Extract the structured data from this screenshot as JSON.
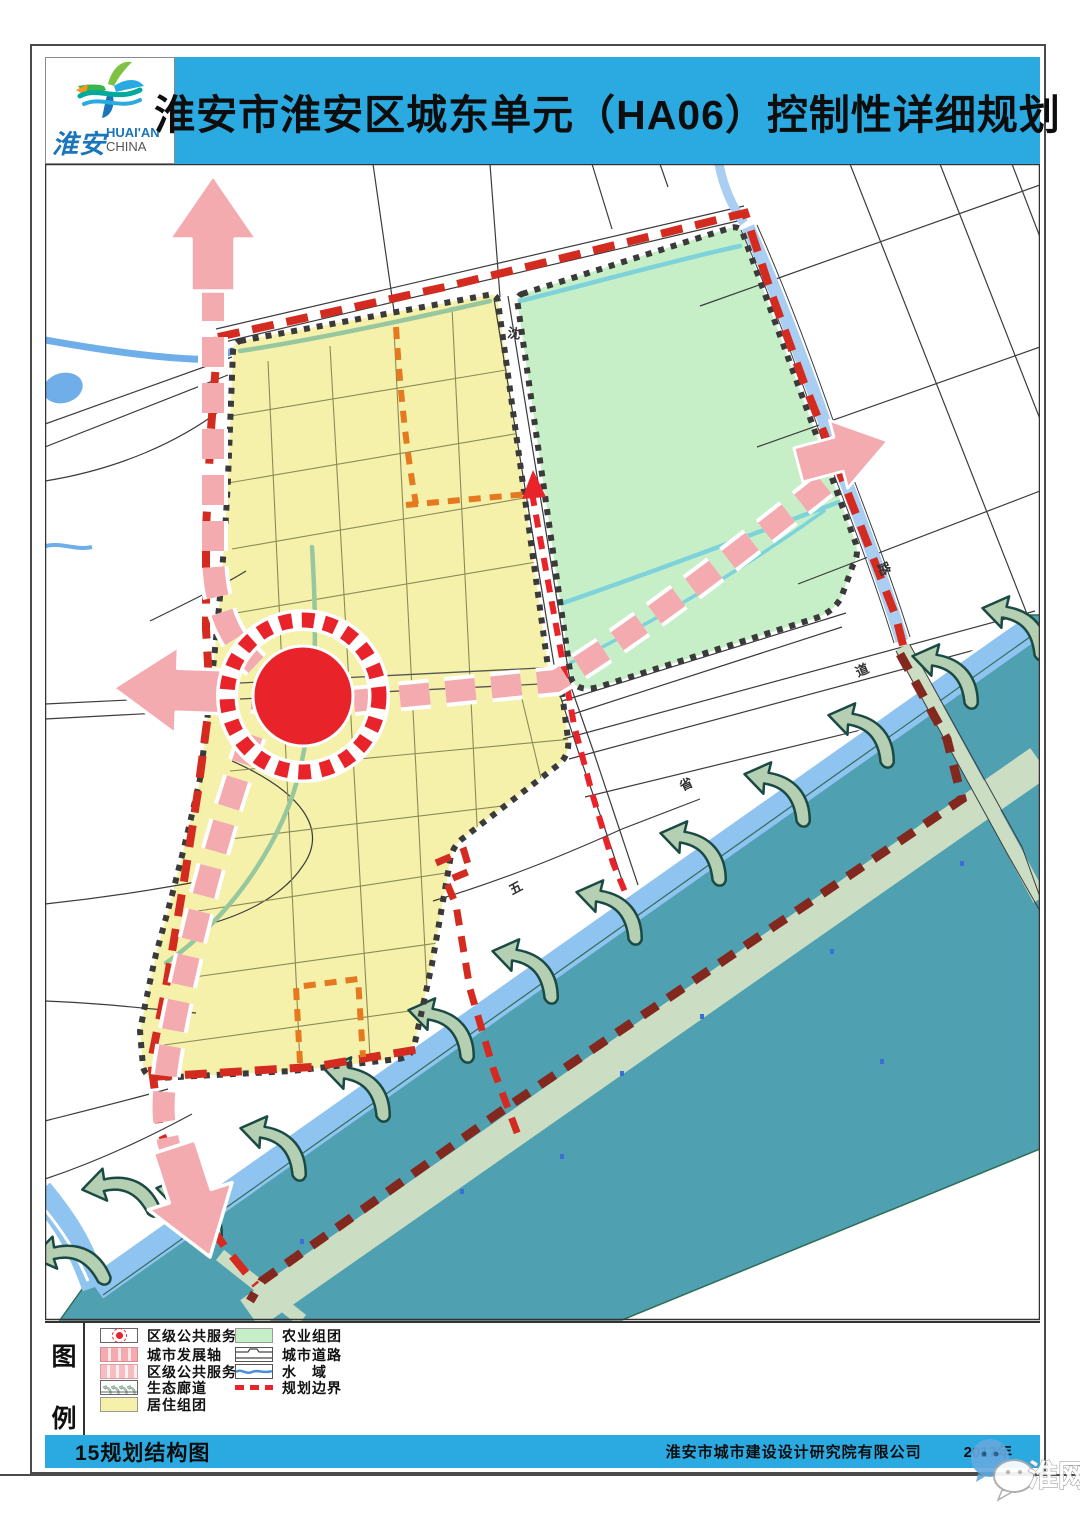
{
  "header": {
    "title": "淮安市淮安区城东单元（HA06）控制性详细规划",
    "logo": {
      "cn": "淮安",
      "en_line1": "HUAI'AN",
      "en_line2": "CHINA"
    }
  },
  "legend": {
    "panel_title_char1": "图",
    "panel_title_char2": "例",
    "col1": [
      {
        "label": "区级公共服务中心",
        "icon": "service-center-symbol"
      },
      {
        "label": "城市发展轴",
        "icon": "city-development-axis-swatch"
      },
      {
        "label": "区级公共服务轴",
        "icon": "district-service-axis-swatch"
      },
      {
        "label": "生态廊道",
        "icon": "ecological-corridor-swatch"
      },
      {
        "label": "居住组团",
        "icon": "residential-cluster-swatch"
      }
    ],
    "col2": [
      {
        "label": "农业组团",
        "icon": "agriculture-cluster-swatch"
      },
      {
        "label": "城市道路",
        "icon": "city-road-swatch"
      },
      {
        "label": "水　域",
        "icon": "water-area-swatch"
      },
      {
        "label": "规划边界",
        "icon": "planning-boundary-swatch"
      }
    ]
  },
  "map": {
    "road_labels": [
      {
        "text": "沈"
      },
      {
        "text": "五"
      },
      {
        "text": "省"
      },
      {
        "text": "道"
      },
      {
        "text": "路"
      }
    ]
  },
  "footer": {
    "figure_label": "15规划结构图",
    "company": "淮安市城市建设设计研究院有限公司",
    "year": "2017年"
  },
  "watermark": {
    "text": "淮网"
  },
  "colors": {
    "header-blue": "#2BAAE1",
    "red": "#E8242A",
    "boundary-red": "#D42B20",
    "maroon": "#82281E",
    "pink": "#F3ABB0",
    "orange": "#E5791F",
    "res-yellow": "#F5F1AA",
    "agri-green": "#C6EEC7",
    "water-teal": "#4FA0B1",
    "shore-blue": "#8FC3F0",
    "river-blue": "#6FAEE8",
    "canal-blue": "#A9CEF2",
    "stream-cyan": "#7ED3DB",
    "stream-olive": "#96C79E",
    "pale-stripe": "#CBDEC4",
    "eco-green": "#B5CFB2",
    "eco-stroke": "#1B4A44"
  }
}
